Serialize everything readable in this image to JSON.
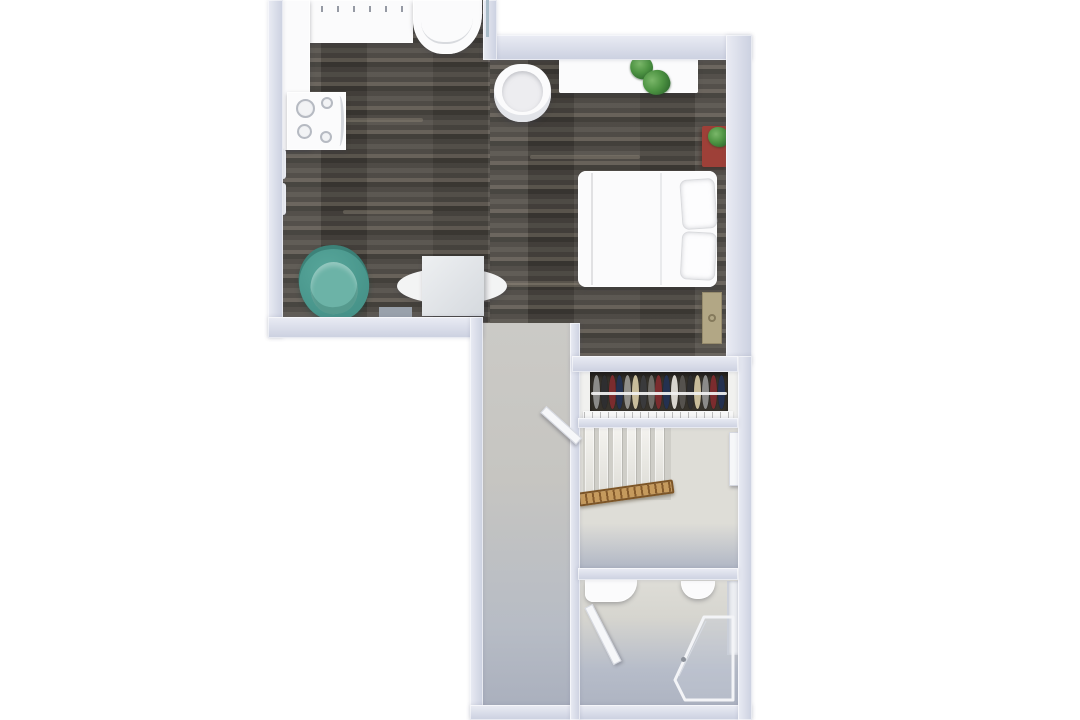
{
  "meta": {
    "description": "Top-down 3D rendered floor plan of a studio apartment with kitchen nook, bed, desk, dining table, hallway, open wardrobe, staircase and bathroom",
    "canvas": {
      "width": 1080,
      "height": 720
    }
  },
  "colors": {
    "wall_light": "#eaecf4",
    "wall_dark": "#cbd0e0",
    "wood_a": "#57534d",
    "wood_b": "#494540",
    "wood_c": "#635d55",
    "wood_d": "#3d3a35",
    "tile_top": "#cbcac6",
    "tile_bottom": "#a9afbd",
    "stairs_bg": "#deddd7",
    "landing": "#b1b7c5",
    "bath_wall": "#deddd7",
    "bath_floor": "#b6bcc9",
    "white_furniture": "#fbfbfc",
    "closet_dark": "#37332c",
    "teal": "#47948a",
    "teal_light": "#6cb3a7",
    "dresser_red": "#9e4038",
    "plant_green": "#4e9443",
    "plant_dark": "#2f6b2e",
    "door_tan": "#b2a785",
    "door_knob": "#857a5c",
    "rail_light": "#c59a5d",
    "rail_dark": "#855b2c"
  },
  "kitchen": {
    "burners": [
      {
        "x": 9,
        "y": 7,
        "d": 19
      },
      {
        "x": 10,
        "y": 32,
        "d": 15
      },
      {
        "x": 34,
        "y": 5,
        "d": 12
      },
      {
        "x": 33,
        "y": 39,
        "d": 12
      }
    ]
  },
  "closet": {
    "clothes_colors": [
      "#8b8b89",
      "#2e2e30",
      "#7b2c2e",
      "#243150",
      "#918f8a",
      "#c9bd9b",
      "#3a3a3c",
      "#6e6b66",
      "#7b2c2e",
      "#243150",
      "#d8d5ce",
      "#55524e",
      "#2e2e30",
      "#c9bd9b",
      "#8b8b89",
      "#7b2c2e",
      "#243150"
    ]
  },
  "stairs": {
    "tread_count": 6,
    "tread_width": 9,
    "tread_gap": 5
  }
}
